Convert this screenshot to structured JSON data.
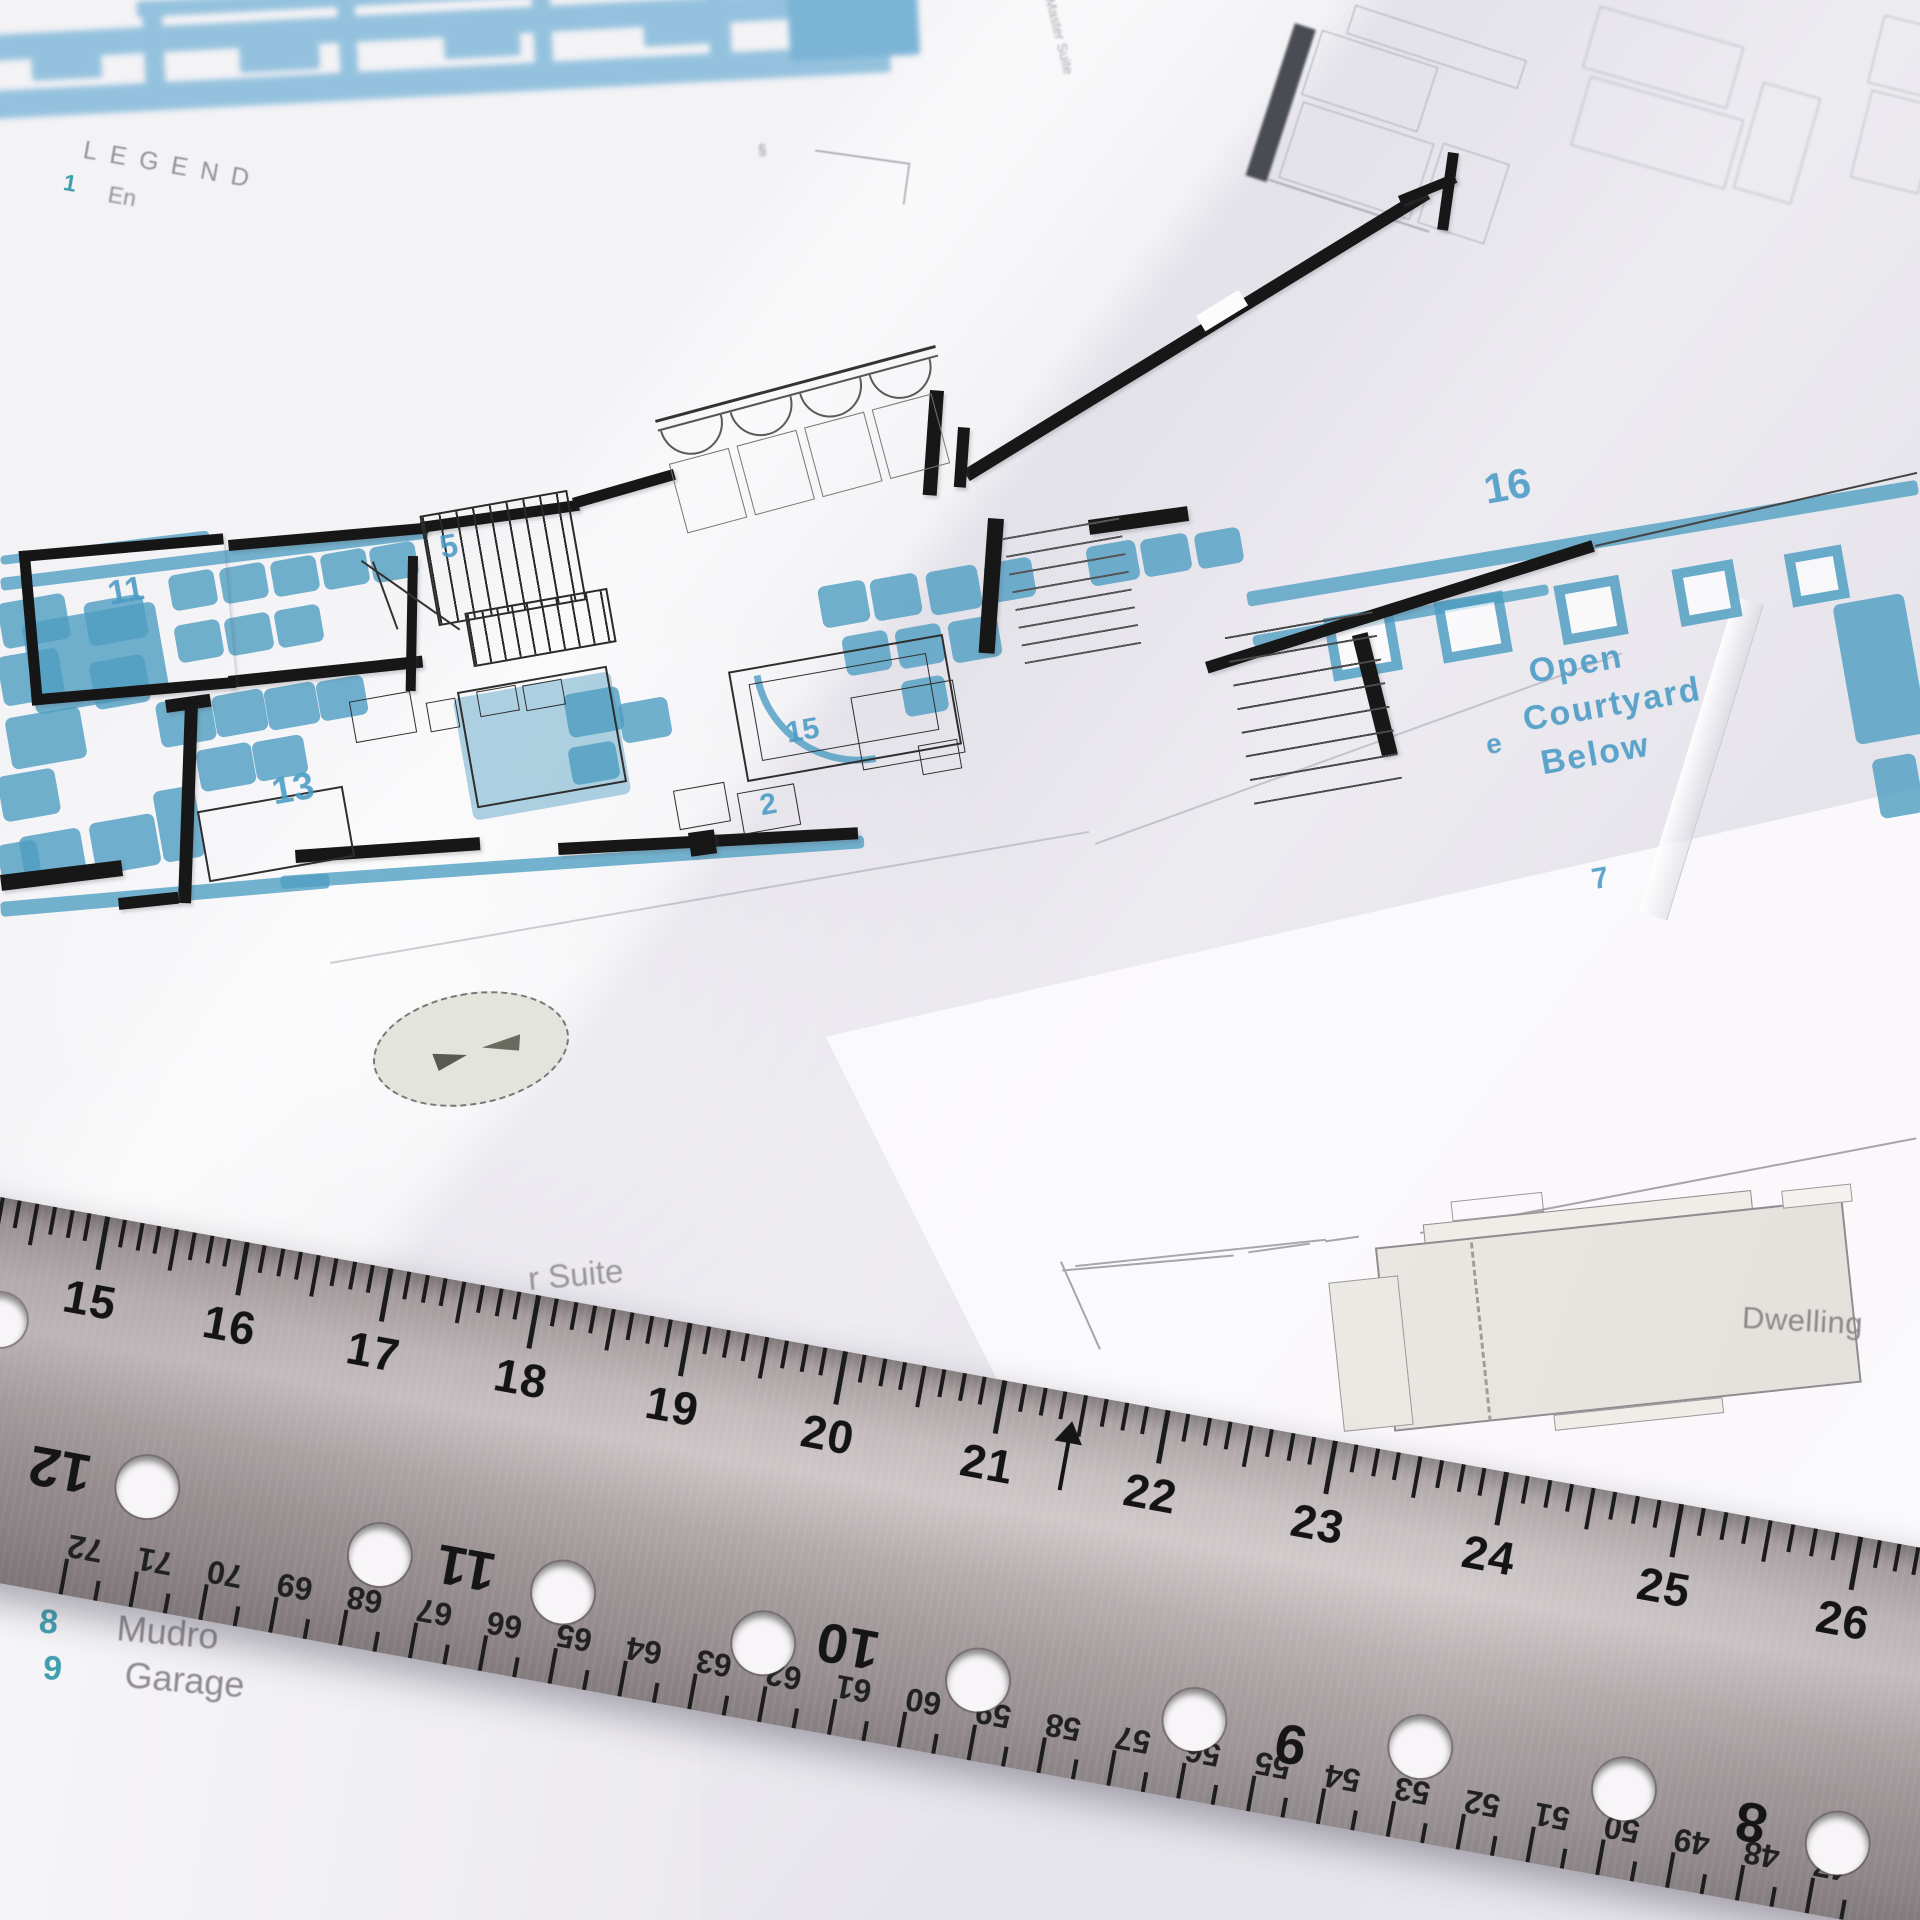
{
  "legend_top": {
    "title": "LEGEND",
    "item_num": "1",
    "item_label": "En"
  },
  "plan_labels": {
    "r11": "11",
    "r5": "5",
    "r13": "13",
    "r15": "15",
    "r2": "2",
    "r16": "16",
    "court_1": "Open",
    "court_2": "Courtyard",
    "court_3": "Below",
    "stray_e": "e",
    "stray_7": "7",
    "suite": "r Suite",
    "faint_suite": "Master Suite"
  },
  "dwelling": {
    "label": "Dwelling"
  },
  "legend_bottom": {
    "rows": [
      {
        "num": "7",
        "label": ""
      },
      {
        "num": "8",
        "label": "Mudro"
      },
      {
        "num": "9",
        "label": "Garage"
      }
    ]
  },
  "ruler": {
    "top_numbers": [
      15,
      16,
      17,
      18,
      19,
      20,
      21,
      22,
      23,
      24,
      25,
      26
    ],
    "arrow_at": 21,
    "bottom_numbers": [
      72,
      71,
      70,
      69,
      68,
      67,
      66,
      65,
      64,
      63,
      62,
      61,
      60,
      59,
      58,
      57,
      56,
      55,
      54,
      53,
      52,
      51,
      50,
      49,
      48,
      47
    ],
    "hole_numbers": [
      "12",
      "11",
      "10",
      "9",
      "8"
    ]
  },
  "colors": {
    "blueprint_blue": "#4d9dc2",
    "blueprint_blue_light": "#7db6d8",
    "legend_teal": "#3f9fae",
    "pencil_gray": "#95919a",
    "ink_black": "#171717",
    "steel_gray": "#b2a9aa"
  }
}
